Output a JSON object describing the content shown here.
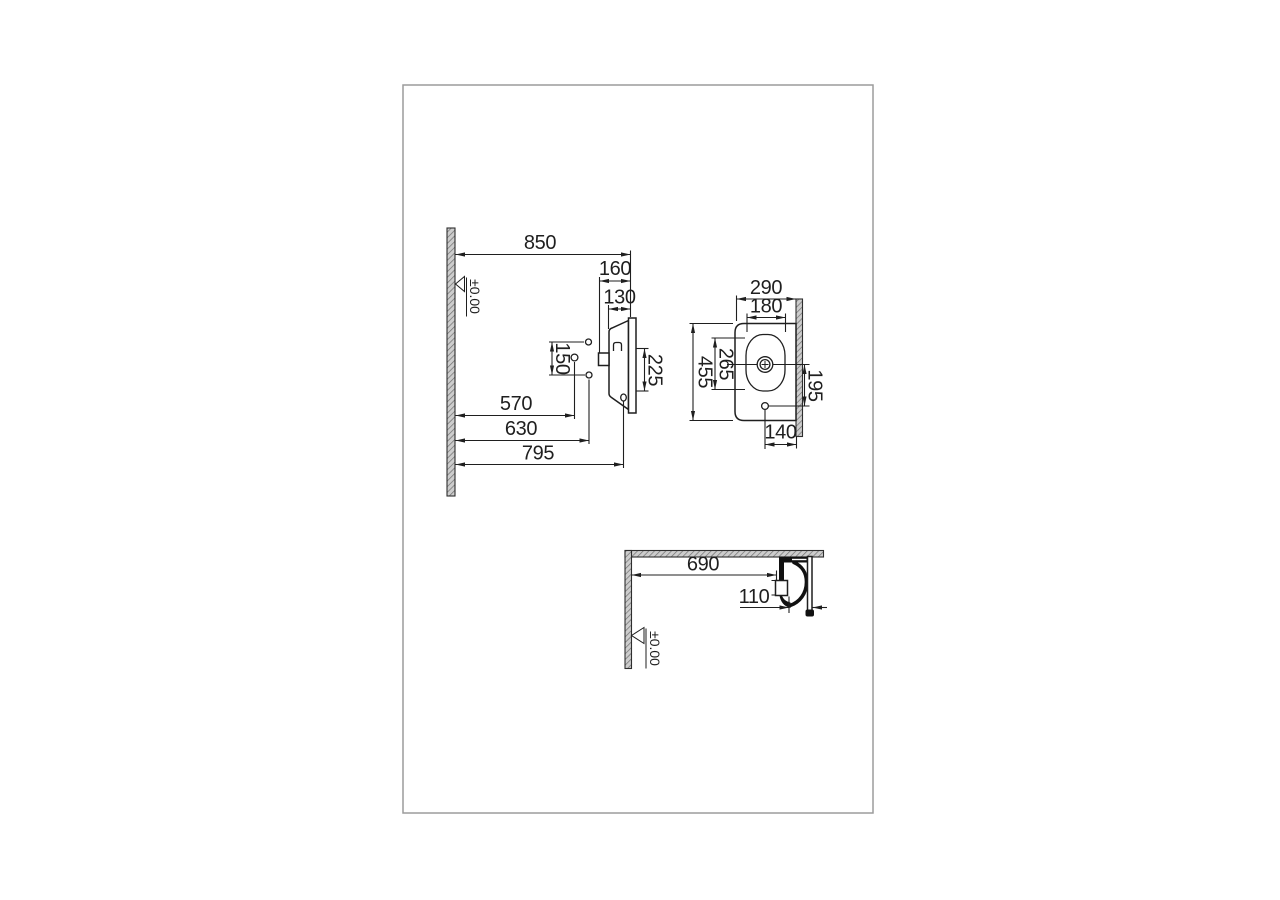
{
  "sheet": {
    "background": "#ffffff",
    "border_color": "#9c9c9c",
    "line_color": "#1f1f1f"
  },
  "views": {
    "side_elevation": {
      "datum_label": "±0.00",
      "dims": {
        "d850": "850",
        "d160": "160",
        "d130": "130",
        "d150": "150",
        "d225": "225",
        "d570": "570",
        "d630": "630",
        "d795": "795"
      }
    },
    "plan": {
      "dims": {
        "d290": "290",
        "d180": "180",
        "d455": "455",
        "d265": "265",
        "d195": "195",
        "d140": "140"
      }
    },
    "section": {
      "datum_label": "±0.00",
      "dims": {
        "d690": "690",
        "d110": "110"
      }
    }
  }
}
